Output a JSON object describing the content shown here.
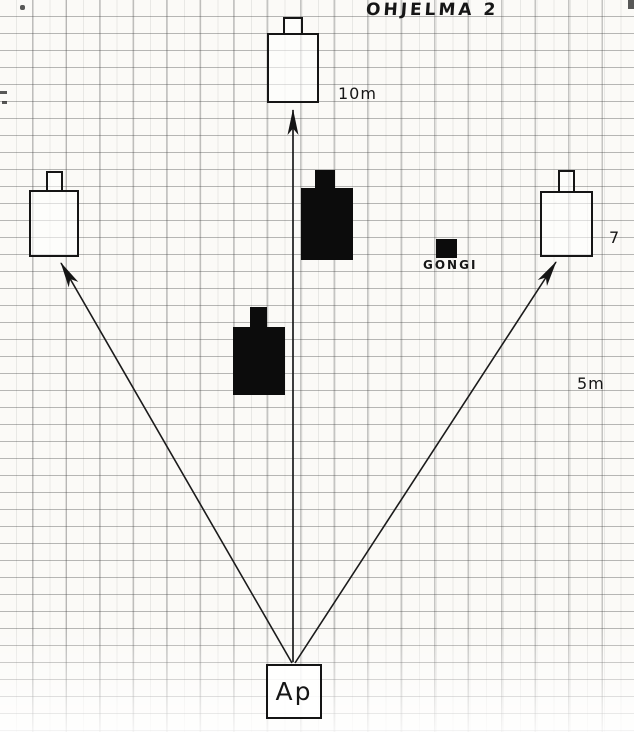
{
  "title": "OHJELMA 2",
  "labels": {
    "top_distance": "10m",
    "right_distance": "7",
    "gong": "GONGI",
    "mid_distance": "5m",
    "start_box": "Ap"
  },
  "colors": {
    "ink": "#161616",
    "paper": "#fbfaf7",
    "grid_line": "#707070",
    "filled_target": "#0c0c0c"
  },
  "diagram": {
    "type": "hand-drawn shooting range program sketch on graph paper",
    "outlined_targets": [
      "top-center target",
      "left target",
      "right target"
    ],
    "filled_targets": [
      "upper-middle black target",
      "lower-middle black target"
    ],
    "gong_marker": "small black square",
    "arrows": [
      "start box to left target",
      "start box to top target",
      "start box to right target"
    ]
  }
}
